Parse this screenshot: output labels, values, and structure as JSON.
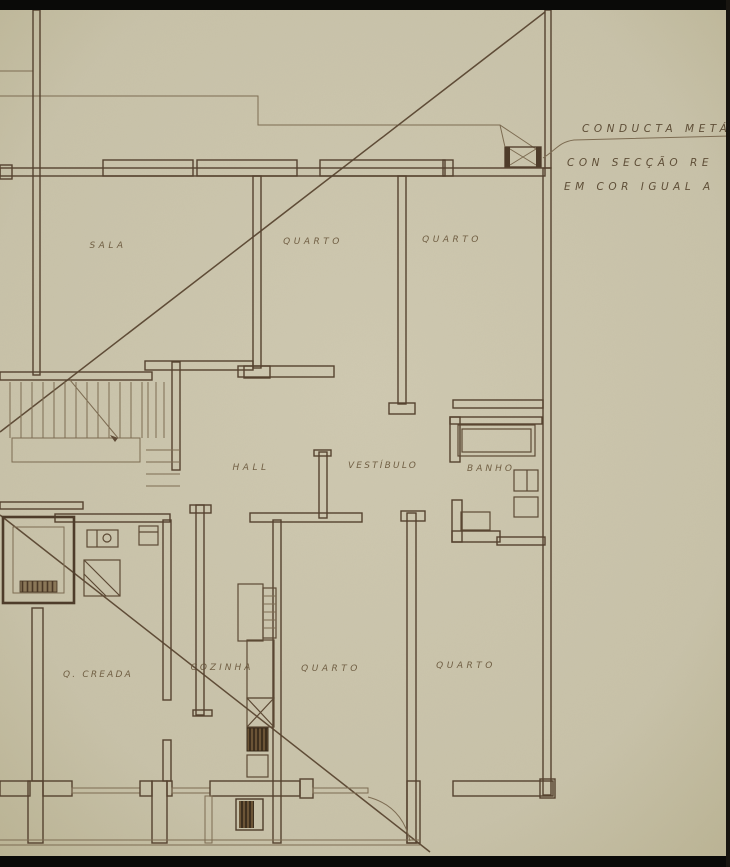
{
  "drawing": {
    "type": "architectural-floor-plan-scan",
    "rooms": {
      "sala": "SALA",
      "quarto_top_left": "QUARTO",
      "quarto_top_right": "QUARTO",
      "hall": "HALL",
      "vestibulo": "VESTÍBULO",
      "banho": "BANHO",
      "q_creada": "Q. CREADA",
      "cozinha": "COZINHA",
      "quarto_bottom_left": "QUARTO",
      "quarto_bottom_right": "QUARTO"
    },
    "annotation": {
      "line1": "CONDUCTA METÁ",
      "line2": "CON SECÇÃO RE",
      "line3": "EM COR IGUAL A"
    },
    "colors": {
      "paper": "#c8c2a9",
      "ink_wall": "#55422f",
      "ink_thin": "#7d6c52",
      "label_ink": "#655236",
      "scan_border": "#0a0a08"
    }
  }
}
